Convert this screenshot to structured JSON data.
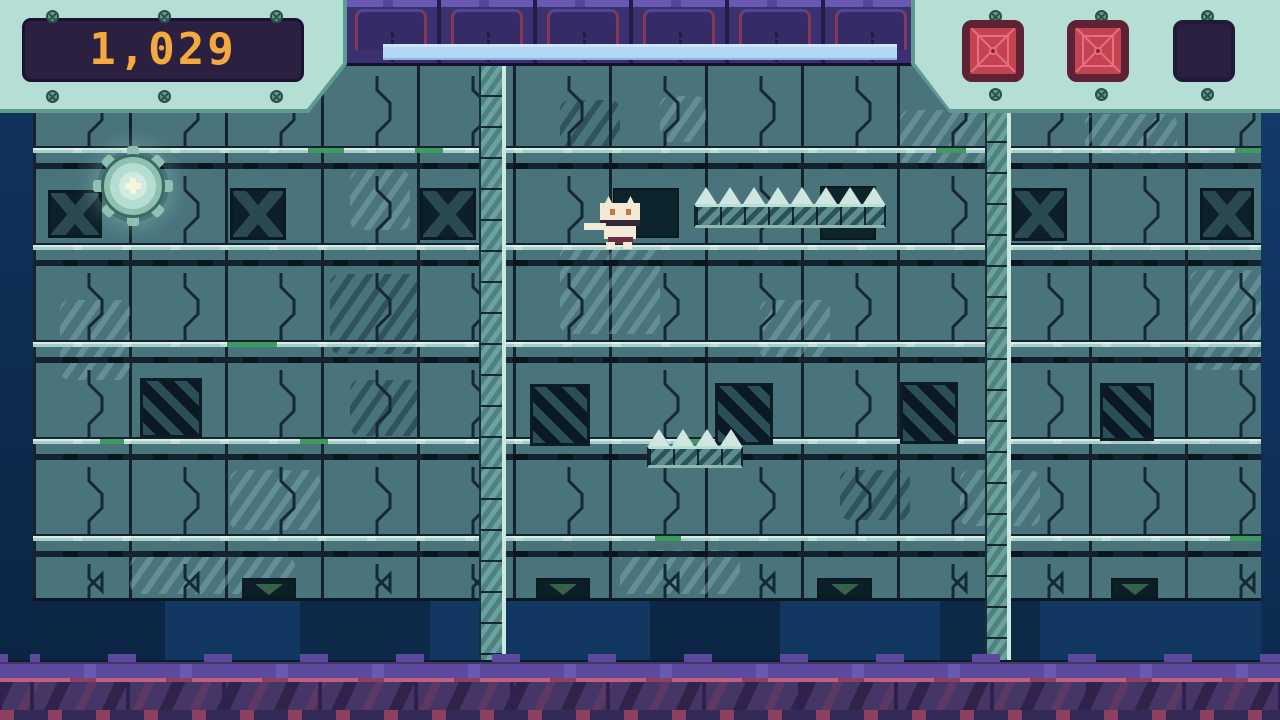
{
  "hud": {
    "score_panel": {
      "value": "1,029"
    },
    "health_bar": {
      "percent": 100
    },
    "item_slots": [
      {
        "name": "item-slot-1",
        "state": "filled"
      },
      {
        "name": "item-slot-2",
        "state": "filled"
      },
      {
        "name": "item-slot-3",
        "state": "empty"
      }
    ]
  },
  "palette": {
    "wall_base": "#49747c",
    "grid_line": "#15232e",
    "rail_light": "#a6cfc7",
    "rail_green": "#3f9a62",
    "rail_dark": "#14232d",
    "panel_mint": "#b5ded5",
    "panel_edge": "#5d9a92",
    "screw": "#5d9e90",
    "screen_bg": "#2c2040",
    "score_color": "#f3a93d",
    "health_fill": "#b4d6f6",
    "slot_red": "#c24452",
    "slot_red_dark": "#5e2234",
    "slot_line": "#ea6e7e",
    "slot_empty": "#2a1f3e",
    "ceiling_base": "#3c3170",
    "ceiling_accent": "#82395a",
    "navy_band": "#0d2c4e",
    "floor_base": "#463668",
    "floor_cap": "#5b4a9e",
    "floor_pink": "#c05f7e",
    "dark_panel": "#0d1f28",
    "vent_green": "#39604a",
    "ladder_base": "#6aa29c",
    "spike": "#cfe7e0",
    "platform": "#5d8e8e",
    "player_cream": "#f2ead6",
    "player_eye": "#c8763c",
    "gear_ring": "#8fc0b2",
    "gear_core": "#f6f6d8"
  },
  "scene": {
    "grid": {
      "col_start": 33,
      "col_width": 96,
      "col_count": 13,
      "wall_left": 33,
      "wall_right": 1262,
      "rail_ys": [
        146,
        243,
        340,
        437,
        534
      ]
    },
    "bracket_rows": [
      {
        "y0": 70,
        "y1": 146,
        "cols": "all"
      },
      {
        "y0": 170,
        "y1": 243,
        "cols": [
          1,
          3,
          5,
          7,
          9,
          11
        ]
      },
      {
        "y0": 267,
        "y1": 340,
        "cols": "all"
      },
      {
        "y0": 364,
        "y1": 437,
        "cols": [
          0,
          2,
          3,
          4,
          6,
          8,
          10,
          12
        ]
      },
      {
        "y0": 461,
        "y1": 534,
        "cols": "all"
      },
      {
        "y0": 558,
        "y1": 600,
        "cols": [
          0,
          1,
          3,
          4,
          6,
          7,
          9,
          10,
          12
        ]
      }
    ],
    "x_panels": [
      [
        48,
        190,
        54,
        48
      ],
      [
        230,
        188,
        56,
        52
      ],
      [
        420,
        188,
        56,
        52
      ],
      [
        1012,
        188,
        55,
        53
      ],
      [
        1200,
        188,
        54,
        52
      ]
    ],
    "dark_panels": [
      [
        613,
        188,
        66,
        50
      ],
      [
        820,
        186,
        56,
        54
      ]
    ],
    "door_panels": [
      [
        140,
        378,
        62,
        60
      ],
      [
        530,
        384,
        60,
        62
      ],
      [
        715,
        383,
        58,
        62
      ],
      [
        900,
        382,
        58,
        62
      ],
      [
        1100,
        383,
        54,
        58
      ]
    ],
    "vents": [
      [
        242,
        578,
        54,
        20
      ],
      [
        536,
        578,
        54,
        20
      ],
      [
        817,
        578,
        55,
        20
      ],
      [
        1111,
        578,
        47,
        20
      ]
    ],
    "green_segments": [
      [
        308,
        146,
        36
      ],
      [
        415,
        146,
        28
      ],
      [
        936,
        146,
        30
      ],
      [
        1235,
        146,
        27
      ],
      [
        227,
        340,
        50
      ],
      [
        100,
        437,
        24
      ],
      [
        300,
        437,
        28
      ],
      [
        680,
        437,
        22
      ],
      [
        655,
        534,
        26
      ],
      [
        1230,
        534,
        32
      ]
    ],
    "mottles": [
      [
        900,
        110,
        90,
        56,
        "light"
      ],
      [
        1085,
        114,
        92,
        40,
        "light"
      ],
      [
        560,
        246,
        100,
        88,
        "light"
      ],
      [
        1190,
        270,
        80,
        100,
        "light"
      ],
      [
        660,
        96,
        46,
        46,
        "light"
      ],
      [
        130,
        556,
        165,
        38,
        "light"
      ],
      [
        620,
        550,
        120,
        44,
        "light"
      ],
      [
        230,
        470,
        90,
        60,
        "light"
      ],
      [
        760,
        300,
        70,
        60,
        "light"
      ],
      [
        60,
        300,
        70,
        80,
        "light"
      ],
      [
        960,
        470,
        80,
        56,
        "light"
      ],
      [
        350,
        170,
        60,
        60,
        "light"
      ],
      [
        330,
        274,
        90,
        80,
        "dark"
      ],
      [
        560,
        100,
        60,
        50,
        "dark"
      ],
      [
        840,
        470,
        70,
        50,
        "dark"
      ],
      [
        350,
        380,
        70,
        56,
        "dark"
      ]
    ],
    "ladders": [
      [
        479,
        64,
        27,
        596
      ],
      [
        985,
        110,
        26,
        550
      ]
    ],
    "spike_platforms": [
      {
        "x": 694,
        "y": 204,
        "w": 192,
        "h": 24,
        "spikes": 8
      },
      {
        "x": 647,
        "y": 446,
        "w": 96,
        "h": 22,
        "spikes": 4
      }
    ],
    "gear": {
      "x": 97,
      "y": 150,
      "size": 72
    },
    "player": {
      "x": 599,
      "y": 196,
      "w": 44,
      "h": 50
    },
    "navy_blocks": [
      [
        33,
        132,
        "#0b2745"
      ],
      [
        165,
        135,
        "#123760"
      ],
      [
        300,
        130,
        "#0c2947"
      ],
      [
        430,
        220,
        "#123760"
      ],
      [
        650,
        130,
        "#0b2745"
      ],
      [
        780,
        160,
        "#123760"
      ],
      [
        940,
        100,
        "#0c2947"
      ],
      [
        1040,
        222,
        "#123760"
      ]
    ],
    "ceiling_tiles": 6
  }
}
